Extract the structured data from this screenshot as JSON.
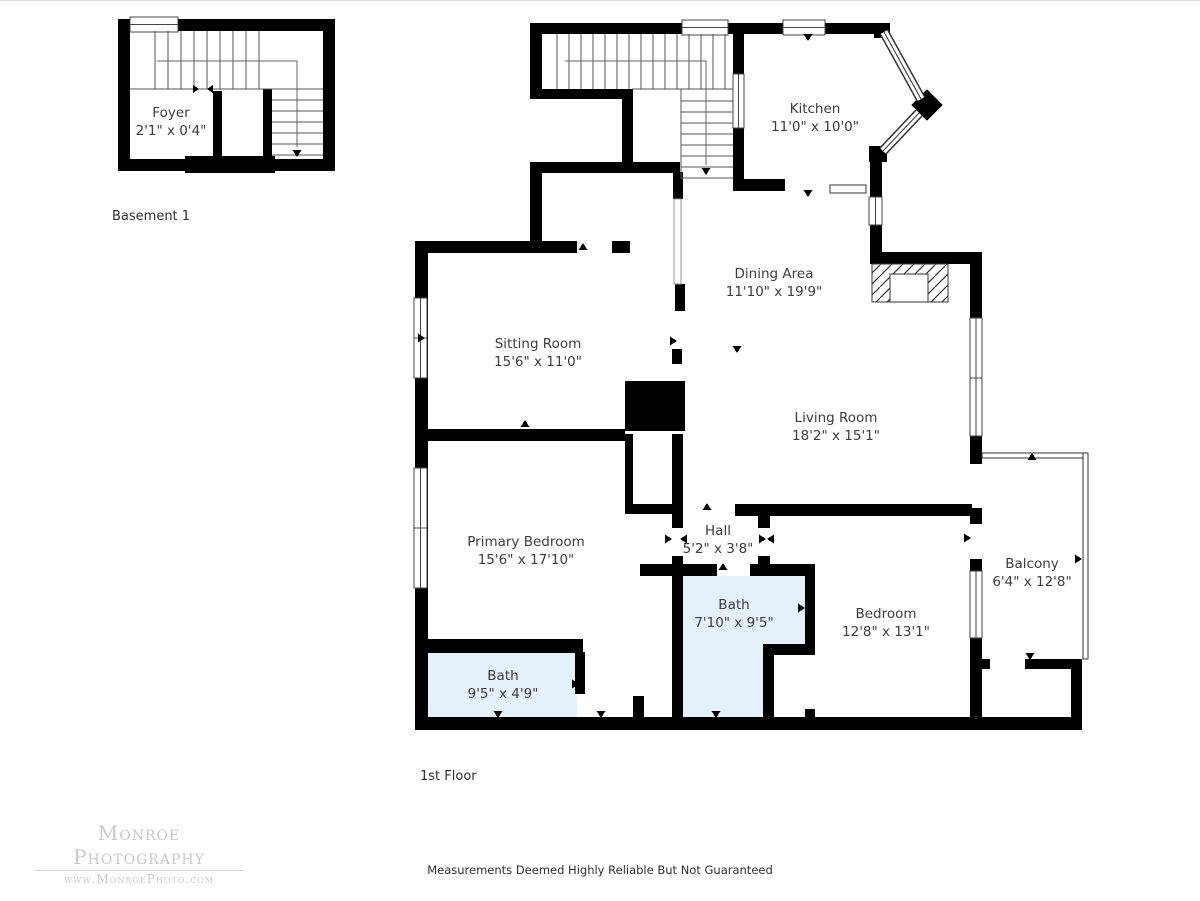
{
  "page": {
    "background": "#ffffff"
  },
  "plans": [
    {
      "id": "basement",
      "title": "Basement 1",
      "rooms": [
        {
          "id": "foyer",
          "name": "Foyer",
          "dims": "2'1\" x 0'4\"",
          "x": 171,
          "y": 121
        }
      ]
    },
    {
      "id": "first-floor",
      "title": "1st Floor",
      "rooms": [
        {
          "id": "kitchen",
          "name": "Kitchen",
          "dims": "11'0\" x 10'0\"",
          "x": 815,
          "y": 117
        },
        {
          "id": "dining-area",
          "name": "Dining Area",
          "dims": "11'10\" x 19'9\"",
          "x": 774,
          "y": 282
        },
        {
          "id": "sitting-room",
          "name": "Sitting Room",
          "dims": "15'6\" x 11'0\"",
          "x": 538,
          "y": 352
        },
        {
          "id": "living-room",
          "name": "Living Room",
          "dims": "18'2\" x 15'1\"",
          "x": 836,
          "y": 426
        },
        {
          "id": "primary-bedroom",
          "name": "Primary Bedroom",
          "dims": "15'6\" x 17'10\"",
          "x": 526,
          "y": 550
        },
        {
          "id": "hall",
          "name": "Hall",
          "dims": "5'2\" x 3'8\"",
          "x": 718,
          "y": 539
        },
        {
          "id": "bath-main",
          "name": "Bath",
          "dims": "7'10\" x 9'5\"",
          "x": 734,
          "y": 613
        },
        {
          "id": "bedroom",
          "name": "Bedroom",
          "dims": "12'8\" x 13'1\"",
          "x": 886,
          "y": 622
        },
        {
          "id": "balcony",
          "name": "Balcony",
          "dims": "6'4\" x 12'8\"",
          "x": 1032,
          "y": 572
        },
        {
          "id": "bath-small",
          "name": "Bath",
          "dims": "9'5\" x 4'9\"",
          "x": 503,
          "y": 684
        }
      ]
    }
  ],
  "watermark": {
    "line1": "Monroe Photography",
    "line2": "www.MonroePhoto.com"
  },
  "disclaimer": "Measurements Deemed Highly Reliable But Not Guaranteed",
  "colors": {
    "wall": "#000000",
    "bath_fill": "#e4f0fa",
    "label_text": "#3d3d3d",
    "watermark_gray": "#c9c9c9"
  }
}
